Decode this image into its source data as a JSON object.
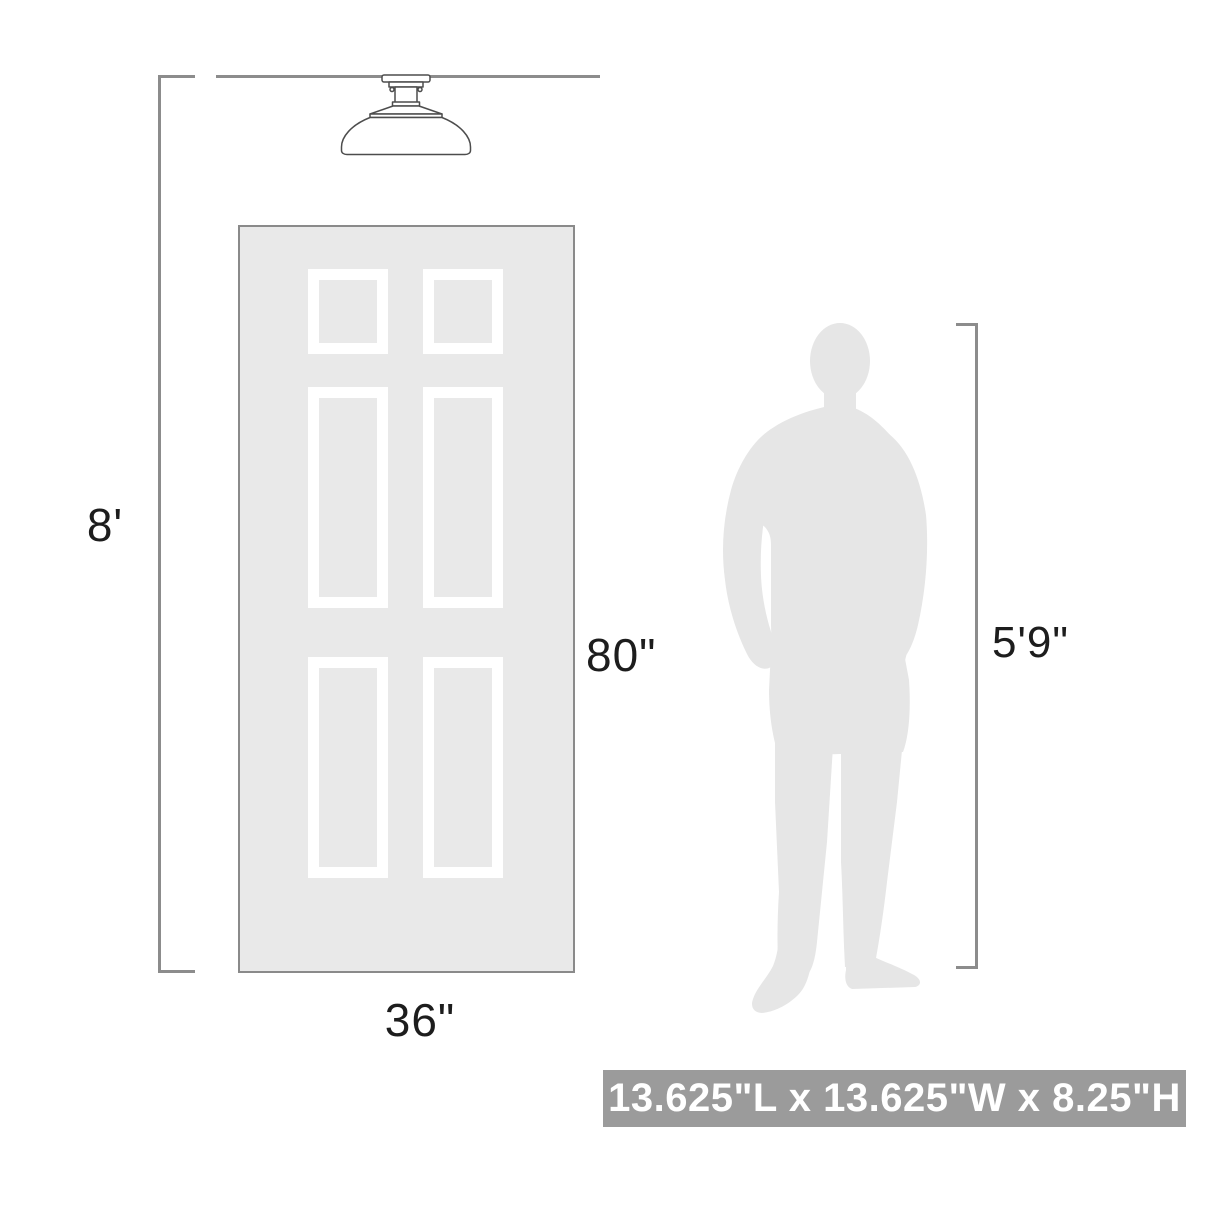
{
  "labels": {
    "ceiling_height": "8'",
    "door_height": "80\"",
    "door_width": "36\"",
    "person_height": "5'9\""
  },
  "banner": {
    "text": "13.625\"L x 13.625\"W x 8.25\"H"
  },
  "icons": {
    "ceiling_light": "semi-flush-dome-ceiling-light",
    "door": "six-panel-door",
    "person": "standing-man-silhouette"
  },
  "colors": {
    "door_fill": "#e9e9e9",
    "door_border": "#8a8a8a",
    "panel_frame": "#ffffff",
    "silhouette_fill": "#e6e6e6",
    "dimension_line": "#8c8c8c",
    "label_text": "#1d1d1d",
    "banner_bg": "#9b9b9b",
    "banner_text": "#ffffff",
    "fixture_stroke": "#4d4d4d",
    "fixture_fill": "#ffffff"
  }
}
